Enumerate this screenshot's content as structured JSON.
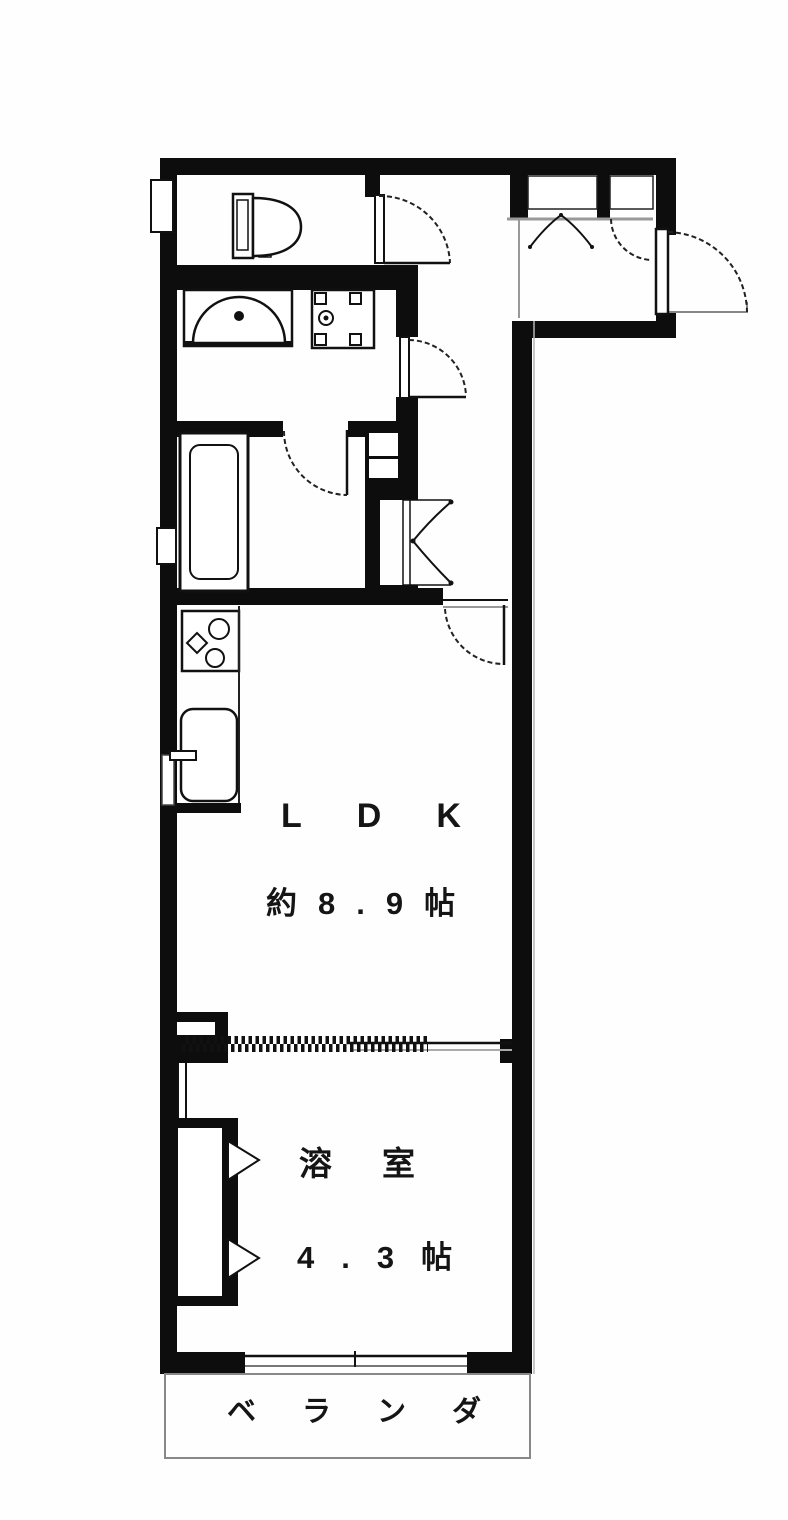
{
  "plan": {
    "type": "apartment-floor-plan",
    "rooms": {
      "ldk": {
        "label": "LDK",
        "size": "約8.9帖"
      },
      "bedroom": {
        "label": "溶室",
        "size": "4.3帖"
      },
      "veranda": {
        "label": "ベランダ"
      }
    },
    "fixtures": [
      "toilet-icon",
      "washbasin-icon",
      "washing-machine-pan-icon",
      "bathtub-icon",
      "stove-icon",
      "kitchen-sink-icon",
      "entrance-door-icon",
      "closet-bifold-icon",
      "sliding-partition-icon",
      "window-icon"
    ],
    "colors": {
      "wall": "#0d0d0d",
      "line": "#222222",
      "gray_line": "#999999",
      "background": "#ffffff"
    }
  }
}
